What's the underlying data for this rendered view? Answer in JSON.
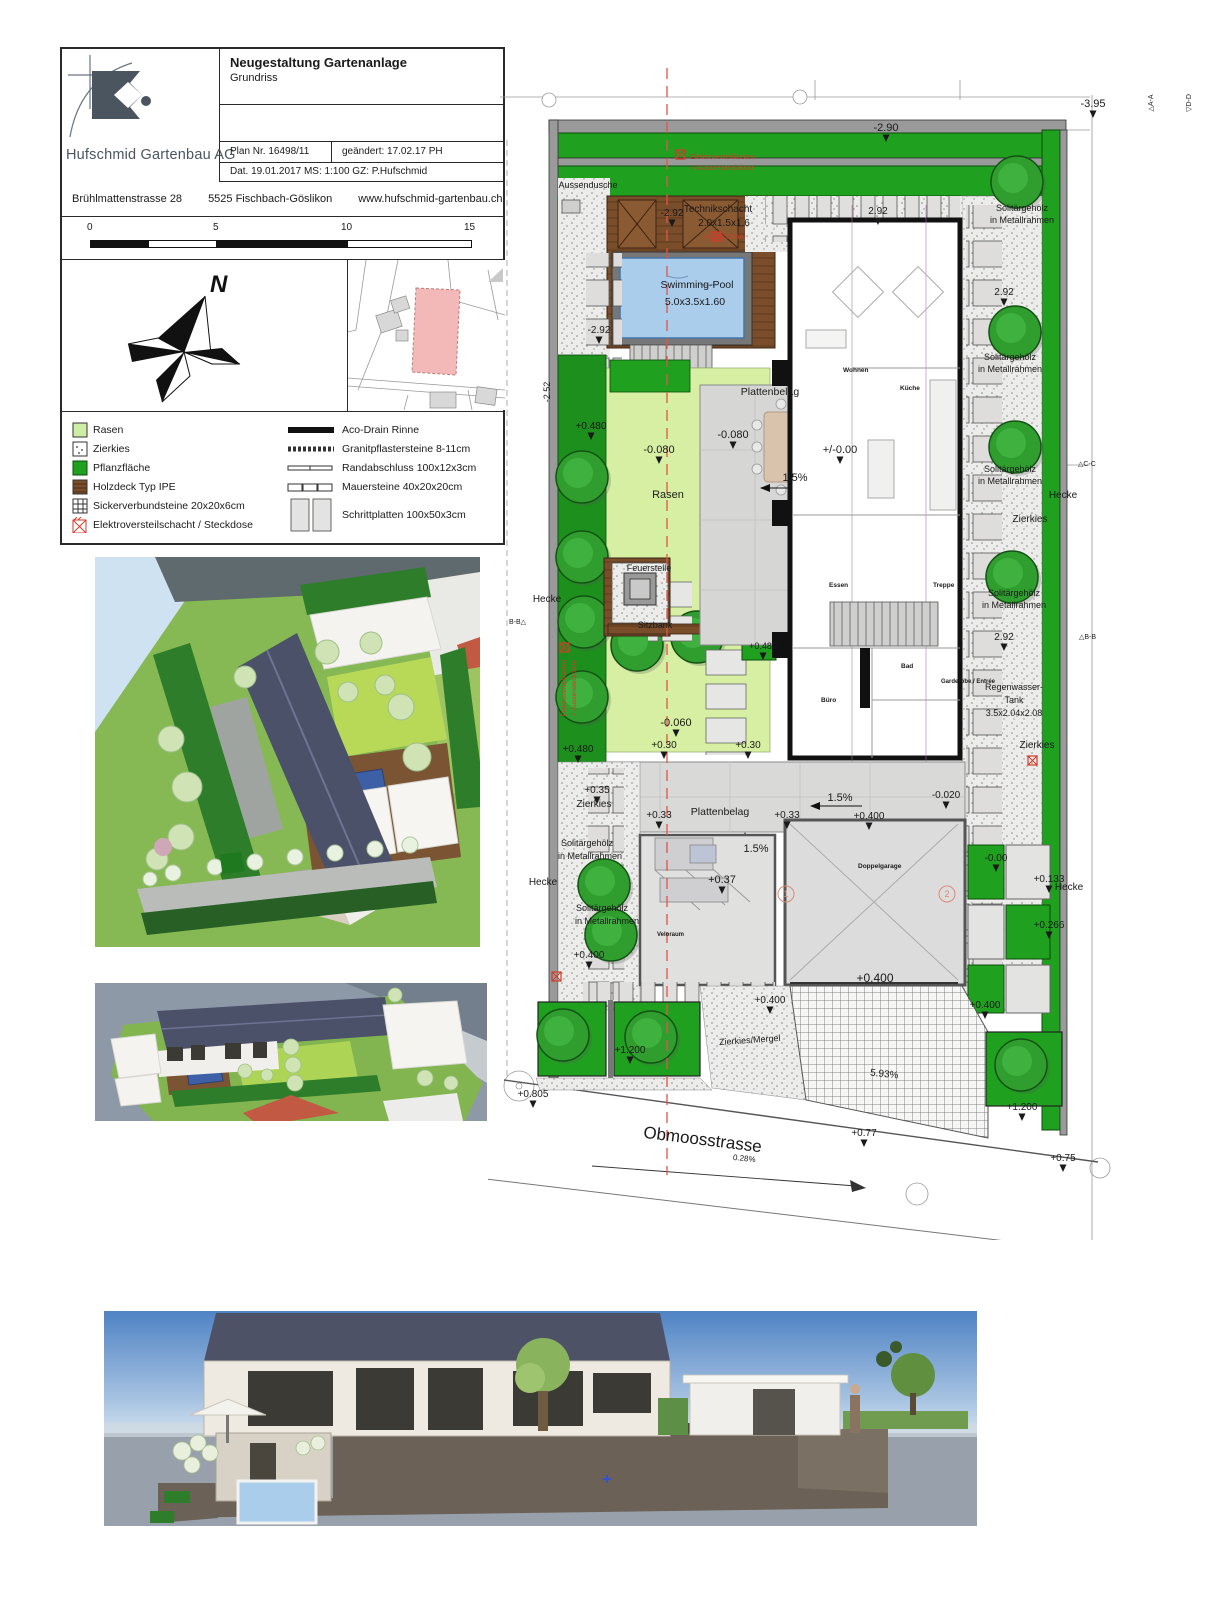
{
  "titleblock": {
    "company": "Hufschmid Gartenbau AG",
    "title": "Neugestaltung Gartenanlage",
    "subtitle": "Grundriss",
    "plan_nr": "Plan Nr. 16498/11",
    "changed": "geändert: 17.02.17 PH",
    "date_line": "Dat. 19.01.2017 MS: 1:100   GZ: P.Hufschmid",
    "address_parts": [
      "Brühlmattenstrasse 28",
      "5525 Fischbach-Göslikon",
      "www.hufschmid-gartenbau.ch"
    ]
  },
  "scalebar": {
    "ticks": [
      "0",
      "5",
      "10",
      "15"
    ]
  },
  "compass": {
    "north_label": "N"
  },
  "legend": {
    "left": [
      {
        "label": "Rasen"
      },
      {
        "label": "Zierkies"
      },
      {
        "label": "Pflanzfläche"
      },
      {
        "label": "Holzdeck Typ IPE"
      },
      {
        "label": "Sickerverbundsteine 20x20x6cm"
      },
      {
        "label": "Elektroversteilschacht / Steckdose"
      }
    ],
    "right": [
      {
        "label": "Aco-Drain Rinne"
      },
      {
        "label": "Granitpflastersteine 8-11cm"
      },
      {
        "label": "Randabschluss 100x12x3cm"
      },
      {
        "label": "Mauersteine 40x20x20cm"
      },
      {
        "label": "Schrittplatten 100x50x3cm"
      }
    ]
  },
  "colors": {
    "hedge_green": "#1fa01f",
    "lawn_green": "#d6efa2",
    "wood_brown": "#7b4e2b",
    "pool_blue": "#aacdec",
    "red_note": "#d23b2a",
    "roof_slate": "#4c516a"
  },
  "plan": {
    "street_label": "Obmoosstrasse",
    "labels": [
      {
        "t": "-3.95",
        "x": 1093,
        "y": 107,
        "s": 11,
        "ar": 1
      },
      {
        "t": "△A-A",
        "x": 1153,
        "y": 103,
        "s": 7,
        "r": -90
      },
      {
        "t": "▽D-D",
        "x": 1191,
        "y": 103,
        "s": 7,
        "r": -90
      },
      {
        "t": "-2.90",
        "x": 886,
        "y": 131,
        "s": 11,
        "ar": 1
      },
      {
        "t": "Elektroverteilkasten",
        "x": 690,
        "y": 159,
        "s": 7.5,
        "c": "#d23b2a",
        "a": "s"
      },
      {
        "t": "+ Aussensteckdose",
        "x": 690,
        "y": 170,
        "s": 7.5,
        "c": "#d23b2a",
        "a": "s"
      },
      {
        "t": "Aussendusche",
        "x": 588,
        "y": 188,
        "s": 9
      },
      {
        "t": "Technikschacht",
        "x": 718,
        "y": 212,
        "s": 10
      },
      {
        "t": "2.0x1.5x1.6",
        "x": 724,
        "y": 226,
        "s": 10
      },
      {
        "t": "4 x 230/ 16A",
        "x": 724,
        "y": 239,
        "s": 7,
        "c": "#d23b2a"
      },
      {
        "t": "-2.92",
        "x": 672,
        "y": 216,
        "s": 10,
        "ar": 1
      },
      {
        "t": "2.92",
        "x": 878,
        "y": 214,
        "s": 10,
        "ar": 1
      },
      {
        "t": "Solitärgehölz",
        "x": 1022,
        "y": 211,
        "s": 9
      },
      {
        "t": "in Metallrahmen",
        "x": 1022,
        "y": 223,
        "s": 9
      },
      {
        "t": "Swimming-Pool",
        "x": 697,
        "y": 288,
        "s": 10.5
      },
      {
        "t": "5.0x3.5x1.60",
        "x": 695,
        "y": 305,
        "s": 10.5
      },
      {
        "t": "2.92",
        "x": 1004,
        "y": 295,
        "s": 10,
        "ar": 1
      },
      {
        "t": "-2.52",
        "x": 550,
        "y": 392,
        "s": 9,
        "r": -90
      },
      {
        "t": "-2.92",
        "x": 599,
        "y": 333,
        "s": 10,
        "ar": 1
      },
      {
        "t": "Solitärgehölz",
        "x": 1010,
        "y": 360,
        "s": 9
      },
      {
        "t": "in Metallrahmen",
        "x": 1010,
        "y": 372,
        "s": 9
      },
      {
        "t": "Wohnen",
        "x": 843,
        "y": 372,
        "s": 6.5,
        "a": "s",
        "b": 1
      },
      {
        "t": "Plattenbelag",
        "x": 770,
        "y": 395,
        "s": 10.5
      },
      {
        "t": "Küche",
        "x": 900,
        "y": 390,
        "s": 6.5,
        "a": "s",
        "b": 1
      },
      {
        "t": "+0.480",
        "x": 591,
        "y": 429,
        "s": 10,
        "ar": 1
      },
      {
        "t": "-0.080",
        "x": 733,
        "y": 438,
        "s": 11,
        "ar": 1
      },
      {
        "t": "-0.080",
        "x": 659,
        "y": 453,
        "s": 11,
        "ar": 1
      },
      {
        "t": "+/-0.00",
        "x": 840,
        "y": 453,
        "s": 11,
        "ar": 1
      },
      {
        "t": "1.5%",
        "x": 795,
        "y": 481,
        "s": 11
      },
      {
        "t": "Rasen",
        "x": 668,
        "y": 498,
        "s": 11
      },
      {
        "t": "Solitärgehölz",
        "x": 1010,
        "y": 472,
        "s": 9
      },
      {
        "t": "in Metallrahmen",
        "x": 1010,
        "y": 484,
        "s": 9
      },
      {
        "t": "△C-C",
        "x": 1078,
        "y": 466,
        "s": 7,
        "a": "s"
      },
      {
        "t": "Hecke",
        "x": 1063,
        "y": 498,
        "s": 10
      },
      {
        "t": "Zierkies",
        "x": 1030,
        "y": 522,
        "s": 10
      },
      {
        "t": "Feuerstelle",
        "x": 649,
        "y": 571,
        "s": 9
      },
      {
        "t": "Essen",
        "x": 829,
        "y": 587,
        "s": 6.5,
        "a": "s",
        "b": 1
      },
      {
        "t": "Treppe",
        "x": 933,
        "y": 587,
        "s": 6.5,
        "a": "s",
        "b": 1
      },
      {
        "t": "B-B△",
        "x": 509,
        "y": 624,
        "s": 7,
        "a": "s"
      },
      {
        "t": "△B-B",
        "x": 1079,
        "y": 639,
        "s": 7,
        "a": "s"
      },
      {
        "t": "Hecke",
        "x": 547,
        "y": 602,
        "s": 10
      },
      {
        "t": "Sitzbank",
        "x": 655,
        "y": 628,
        "s": 9
      },
      {
        "t": "+0.480",
        "x": 763,
        "y": 649,
        "s": 9,
        "ar": 1
      },
      {
        "t": "2.92",
        "x": 1004,
        "y": 640,
        "s": 10,
        "ar": 1
      },
      {
        "t": "Solitärgehölz",
        "x": 1014,
        "y": 596,
        "s": 9
      },
      {
        "t": "in Metallrahmen",
        "x": 1014,
        "y": 608,
        "s": 9
      },
      {
        "t": "Elektroverteilkasten",
        "x": 566,
        "y": 688,
        "s": 6.5,
        "c": "#d23b2a",
        "r": -90
      },
      {
        "t": "+ Aussensteckdose",
        "x": 576,
        "y": 688,
        "s": 6.5,
        "c": "#d23b2a",
        "r": -90
      },
      {
        "t": "-0.060",
        "x": 676,
        "y": 726,
        "s": 11,
        "ar": 1
      },
      {
        "t": "Büro",
        "x": 821,
        "y": 702,
        "s": 6.5,
        "a": "s",
        "b": 1
      },
      {
        "t": "Bad",
        "x": 901,
        "y": 668,
        "s": 6.5,
        "a": "s",
        "b": 1
      },
      {
        "t": "Garderobe / Entrée",
        "x": 941,
        "y": 683,
        "s": 6,
        "a": "s",
        "b": 1
      },
      {
        "t": "Regenwasser-",
        "x": 1014,
        "y": 690,
        "s": 9
      },
      {
        "t": "Tank",
        "x": 1014,
        "y": 703,
        "s": 9
      },
      {
        "t": "3.5x2.04x2.08",
        "x": 1014,
        "y": 716,
        "s": 9
      },
      {
        "t": "Zierkies",
        "x": 1037,
        "y": 748,
        "s": 10
      },
      {
        "t": "+0.480",
        "x": 578,
        "y": 752,
        "s": 10,
        "ar": 1
      },
      {
        "t": "+0.30",
        "x": 664,
        "y": 748,
        "s": 10,
        "ar": 1
      },
      {
        "t": "+0.30",
        "x": 748,
        "y": 748,
        "s": 10,
        "ar": 1
      },
      {
        "t": "+0.35",
        "x": 597,
        "y": 793,
        "s": 10,
        "ar": 1
      },
      {
        "t": "Zierkies",
        "x": 594,
        "y": 807,
        "s": 10
      },
      {
        "t": "+0.33",
        "x": 659,
        "y": 818,
        "s": 10,
        "ar": 1
      },
      {
        "t": "Plattenbelag",
        "x": 720,
        "y": 815,
        "s": 10.5
      },
      {
        "t": "+0.33",
        "x": 787,
        "y": 818,
        "s": 10,
        "ar": 1
      },
      {
        "t": "1.5%",
        "x": 840,
        "y": 801,
        "s": 11
      },
      {
        "t": "+0.400",
        "x": 869,
        "y": 819,
        "s": 10,
        "ar": 1
      },
      {
        "t": "-0.020",
        "x": 946,
        "y": 798,
        "s": 10,
        "ar": 1
      },
      {
        "t": "1.5%",
        "x": 756,
        "y": 852,
        "s": 11
      },
      {
        "t": "+0.37",
        "x": 722,
        "y": 883,
        "s": 11,
        "ar": 1
      },
      {
        "t": "Solitärgehölz",
        "x": 587,
        "y": 846,
        "s": 9
      },
      {
        "t": "in Metallrahmen",
        "x": 590,
        "y": 859,
        "s": 9
      },
      {
        "t": "Hecke",
        "x": 543,
        "y": 885,
        "s": 10
      },
      {
        "t": "-0.00",
        "x": 996,
        "y": 861,
        "s": 10,
        "ar": 1
      },
      {
        "t": "+0.133",
        "x": 1049,
        "y": 882,
        "s": 10,
        "ar": 1
      },
      {
        "t": "Hecke",
        "x": 1069,
        "y": 890,
        "s": 10
      },
      {
        "t": "Solitärgehölz",
        "x": 602,
        "y": 911,
        "s": 9
      },
      {
        "t": "in Metallrahmen",
        "x": 607,
        "y": 924,
        "s": 9
      },
      {
        "t": "+0.266",
        "x": 1049,
        "y": 928,
        "s": 10,
        "ar": 1
      },
      {
        "t": "+0.400",
        "x": 589,
        "y": 958,
        "s": 10,
        "ar": 1
      },
      {
        "t": "Doppelgarage",
        "x": 858,
        "y": 868,
        "s": 6.5,
        "a": "s",
        "b": 1
      },
      {
        "t": "Veloraum",
        "x": 657,
        "y": 936,
        "s": 6,
        "a": "s",
        "b": 1
      },
      {
        "t": "1",
        "x": 786,
        "y": 897,
        "s": 9,
        "c": "#dd8a70"
      },
      {
        "t": "2",
        "x": 947,
        "y": 897,
        "s": 9,
        "c": "#dd8a70"
      },
      {
        "t": "+0.400",
        "x": 770,
        "y": 1003,
        "s": 10,
        "ar": 1
      },
      {
        "t": "+0.400",
        "x": 875,
        "y": 982,
        "s": 12
      },
      {
        "t": "+0.400",
        "x": 985,
        "y": 1008,
        "s": 10,
        "ar": 1
      },
      {
        "t": "+1.200",
        "x": 630,
        "y": 1053,
        "s": 10,
        "ar": 1
      },
      {
        "t": "Zierkies/Mergel",
        "x": 750,
        "y": 1043,
        "s": 9,
        "r": -4
      },
      {
        "t": "5.93%",
        "x": 884,
        "y": 1077,
        "s": 10,
        "r": 6
      },
      {
        "t": "+0.805",
        "x": 533,
        "y": 1097,
        "s": 10,
        "ar": 1
      },
      {
        "t": "Obmoosstrasse",
        "x": 702,
        "y": 1145,
        "s": 17,
        "r": 7
      },
      {
        "t": "0.28%",
        "x": 744,
        "y": 1161,
        "s": 8,
        "r": 6
      },
      {
        "t": "+0.77",
        "x": 864,
        "y": 1136,
        "s": 10,
        "ar": 1
      },
      {
        "t": "+1.200",
        "x": 1022,
        "y": 1110,
        "s": 10,
        "ar": 1
      },
      {
        "t": "+0.75",
        "x": 1063,
        "y": 1161,
        "s": 10,
        "ar": 1
      }
    ]
  }
}
